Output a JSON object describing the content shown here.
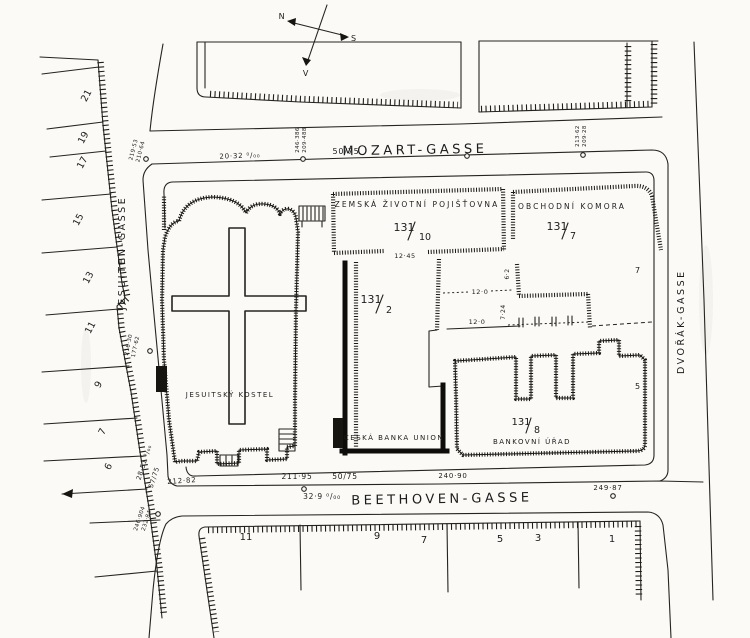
{
  "compass": {
    "n": "N",
    "s": "S",
    "v": "V"
  },
  "streets": {
    "mozart": {
      "name": "MOZART-GASSE",
      "profile": "50/75",
      "grade": "20·32 ⁰/₀₀"
    },
    "beethoven": {
      "name": "BEETHOVEN-GASSE",
      "profile": "50/75",
      "grade": "32·9 ⁰/₀₀",
      "len1": "212·82",
      "len2": "211·95",
      "len3": "240·90",
      "len4": "249·87"
    },
    "jesuiten": {
      "name": "JESUITEN-GASSE",
      "profile": "57/75",
      "grade": "28·51 ⁰/₀₀"
    },
    "dvorak": {
      "name": "DVOŘÁK-GASSE"
    }
  },
  "benchmarks": {
    "mozart_left": {
      "a": "246·386",
      "b": "209·488"
    },
    "mozart_right": {
      "a": "213·62",
      "b": "209·28"
    },
    "jesuiten_top": {
      "a": "219·53",
      "b": "210·64"
    },
    "jesuiten_mid": {
      "a": "216·30",
      "b": "177·62"
    },
    "jesuiten_low": {
      "a": "246·904",
      "b": "232·84"
    }
  },
  "buildings": {
    "church": {
      "label": "JESUITSKÝ KOSTEL"
    },
    "insurance": {
      "label": "ZEMSKÁ ŽIVOTNÍ POJIŠŤOVNA",
      "parcel_num": "131",
      "parcel_den": "10"
    },
    "chamber": {
      "label": "OBCHODNÍ KOMORA",
      "parcel_num": "131",
      "parcel_den": "7"
    },
    "parcel2": {
      "parcel_num": "131",
      "parcel_den": "2"
    },
    "bank_union": {
      "label": "ČESKÁ BANKA UNION"
    },
    "bank_office": {
      "label": "BANKOVNÍ ÚŘAD",
      "parcel_num": "131",
      "parcel_den": "8"
    }
  },
  "dimensions": {
    "w_gap": "12·45",
    "w_mid": "12·0",
    "w_low": "12·0",
    "h_side": "7·24",
    "h_small": "6·2"
  },
  "lots_left": [
    "21",
    "19",
    "17",
    "15",
    "13",
    "11",
    "9",
    "7",
    "6"
  ],
  "lots_right": [
    "7",
    "5"
  ],
  "lots_bottom": [
    "11",
    "9",
    "7",
    "5",
    "3",
    "1"
  ]
}
